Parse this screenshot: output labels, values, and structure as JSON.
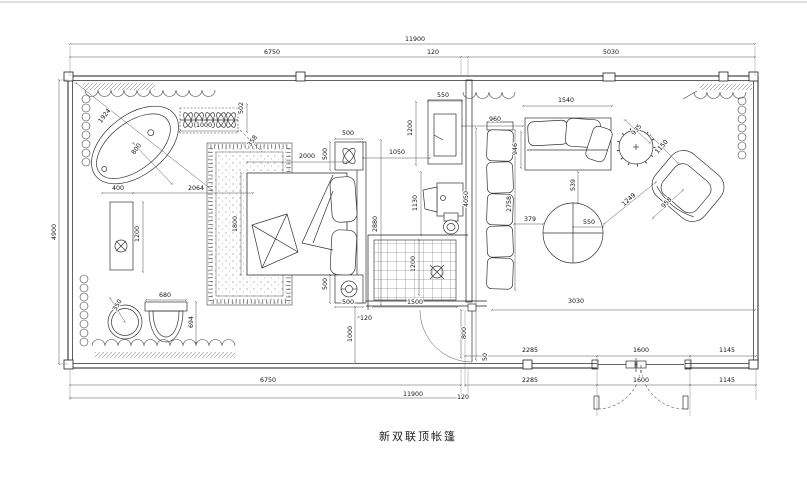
{
  "title": "新双联顶帐篷",
  "drawing": {
    "type": "floor-plan",
    "overall_width_label": "11900",
    "overall_depth_label": "4900"
  },
  "dim_labels": [
    {
      "t": "11900",
      "x": 415,
      "y": 41,
      "r": 0
    },
    {
      "t": "6750",
      "x": 272,
      "y": 54,
      "r": 0
    },
    {
      "t": "120",
      "x": 433,
      "y": 54,
      "r": 0
    },
    {
      "t": "5030",
      "x": 611,
      "y": 54,
      "r": 0
    },
    {
      "t": "4900",
      "x": 56,
      "y": 232,
      "r": -90
    },
    {
      "t": "1924",
      "x": 106,
      "y": 117,
      "r": -52
    },
    {
      "t": "800",
      "x": 138,
      "y": 150,
      "r": -55
    },
    {
      "t": "1000",
      "x": 204,
      "y": 127,
      "r": 0
    },
    {
      "t": "502",
      "x": 243,
      "y": 108,
      "r": -90
    },
    {
      "t": "400",
      "x": 118,
      "y": 190,
      "r": 0
    },
    {
      "t": "2064",
      "x": 196,
      "y": 190,
      "r": 0
    },
    {
      "t": "1200",
      "x": 139,
      "y": 234,
      "r": -90
    },
    {
      "t": "350",
      "x": 119,
      "y": 306,
      "r": -60
    },
    {
      "t": "680",
      "x": 165,
      "y": 297,
      "r": 0
    },
    {
      "t": "694",
      "x": 193,
      "y": 322,
      "r": -90
    },
    {
      "t": "358",
      "x": 254,
      "y": 142,
      "r": -55
    },
    {
      "t": "2000",
      "x": 307,
      "y": 158,
      "r": 0
    },
    {
      "t": "500",
      "x": 348,
      "y": 135,
      "r": 0
    },
    {
      "t": "500",
      "x": 327,
      "y": 154,
      "r": -90
    },
    {
      "t": "1800",
      "x": 237,
      "y": 224,
      "r": -90
    },
    {
      "t": "2880",
      "x": 377,
      "y": 224,
      "r": -90
    },
    {
      "t": "500",
      "x": 327,
      "y": 284,
      "r": -90
    },
    {
      "t": "500",
      "x": 348,
      "y": 304,
      "r": 0
    },
    {
      "t": "120",
      "x": 366,
      "y": 320,
      "r": 0
    },
    {
      "t": "1000",
      "x": 352,
      "y": 334,
      "r": -90
    },
    {
      "t": "550",
      "x": 443,
      "y": 97,
      "r": 0
    },
    {
      "t": "1200",
      "x": 412,
      "y": 128,
      "r": -90
    },
    {
      "t": "1050",
      "x": 397,
      "y": 154,
      "r": 0
    },
    {
      "t": "1130",
      "x": 417,
      "y": 203,
      "r": -90
    },
    {
      "t": "4050",
      "x": 468,
      "y": 199,
      "r": -90
    },
    {
      "t": "1200",
      "x": 415,
      "y": 264,
      "r": -90
    },
    {
      "t": "1500",
      "x": 415,
      "y": 304,
      "r": 0
    },
    {
      "t": "800",
      "x": 466,
      "y": 333,
      "r": -90
    },
    {
      "t": "50",
      "x": 487,
      "y": 357,
      "r": -90
    },
    {
      "t": "960",
      "x": 495,
      "y": 121,
      "r": 0
    },
    {
      "t": "1540",
      "x": 566,
      "y": 102,
      "r": 0
    },
    {
      "t": "946",
      "x": 517,
      "y": 149,
      "r": -90
    },
    {
      "t": "2758",
      "x": 511,
      "y": 204,
      "r": -90
    },
    {
      "t": "539",
      "x": 575,
      "y": 185,
      "r": -90
    },
    {
      "t": "379",
      "x": 530,
      "y": 221,
      "r": 0
    },
    {
      "t": "550",
      "x": 589,
      "y": 224,
      "r": 0
    },
    {
      "t": "935",
      "x": 638,
      "y": 131,
      "r": -50
    },
    {
      "t": "1150",
      "x": 663,
      "y": 148,
      "r": -48
    },
    {
      "t": "1249",
      "x": 630,
      "y": 201,
      "r": -42
    },
    {
      "t": "958",
      "x": 668,
      "y": 204,
      "r": -48
    },
    {
      "t": "3030",
      "x": 576,
      "y": 303,
      "r": 0
    },
    {
      "t": "2285",
      "x": 530,
      "y": 352,
      "r": 0
    },
    {
      "t": "1600",
      "x": 641,
      "y": 352,
      "r": 0
    },
    {
      "t": "1145",
      "x": 727,
      "y": 352,
      "r": 0
    },
    {
      "t": "6750",
      "x": 268,
      "y": 382,
      "r": 0
    },
    {
      "t": "2285",
      "x": 530,
      "y": 382,
      "r": 0
    },
    {
      "t": "1600",
      "x": 641,
      "y": 382,
      "r": 0
    },
    {
      "t": "1145",
      "x": 727,
      "y": 382,
      "r": 0
    },
    {
      "t": "11900",
      "x": 413,
      "y": 396,
      "r": 0
    },
    {
      "t": "120",
      "x": 463,
      "y": 399,
      "r": 0
    }
  ]
}
